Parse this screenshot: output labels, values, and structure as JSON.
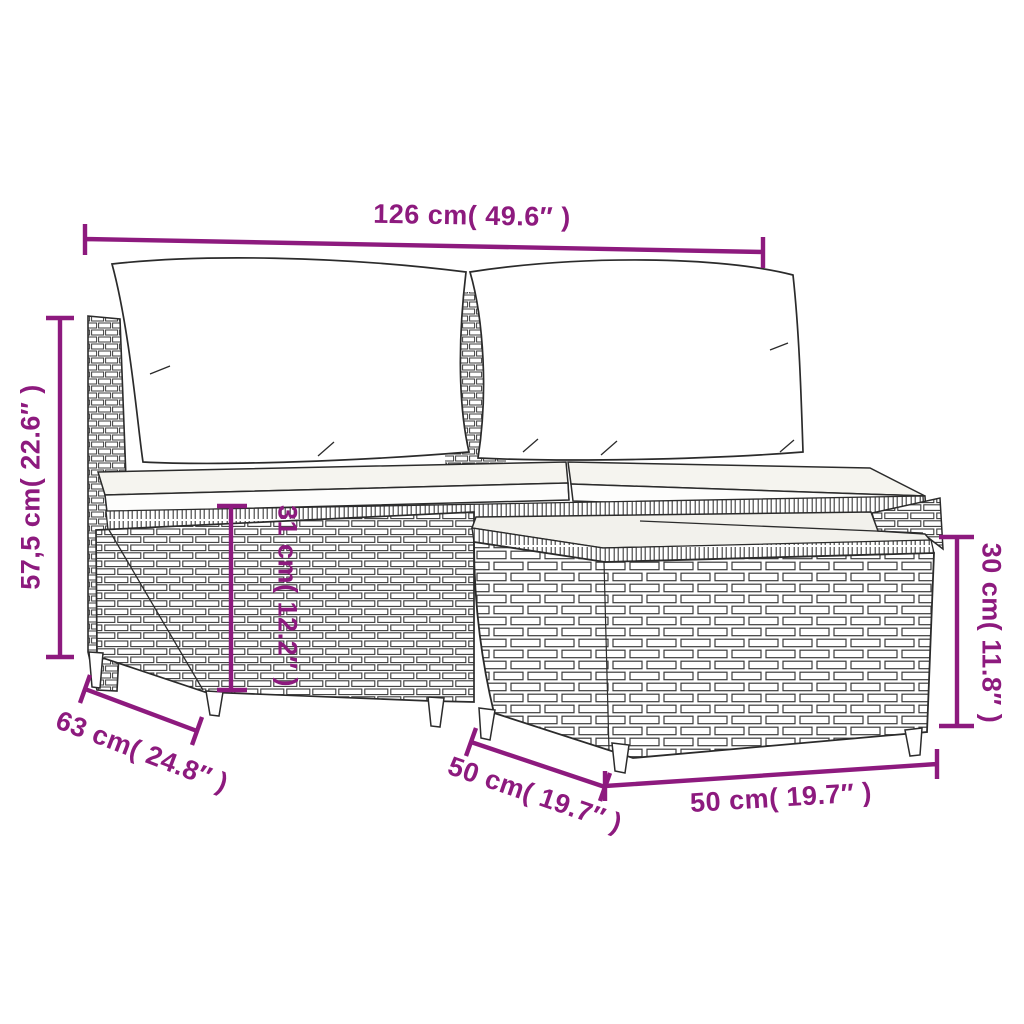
{
  "diagram": {
    "subject": "poly rattan garden lounge set with white cushions and wicker footstool table",
    "style": "black line-art product dimension drawing on white background",
    "annotation_color": "#8d1a7e",
    "line_color": "#2b2b2b",
    "dimensions": [
      {
        "id": "overall-width",
        "label": "126 cm( 49.6″ )",
        "orientation": "horizontal",
        "position": "top"
      },
      {
        "id": "overall-height",
        "label": "57,5 cm( 22.6″ )",
        "orientation": "vertical",
        "position": "left"
      },
      {
        "id": "seat-height",
        "label": "31 cm( 12.2″ )",
        "orientation": "vertical",
        "position": "center"
      },
      {
        "id": "footstool-height",
        "label": "30 cm( 11.8″ )",
        "orientation": "vertical",
        "position": "right"
      },
      {
        "id": "sofa-depth",
        "label": "63 cm( 24.8″ )",
        "orientation": "diagonal",
        "position": "bottom-left"
      },
      {
        "id": "footstool-depth",
        "label": "50 cm( 19.7″ )",
        "orientation": "diagonal",
        "position": "bottom-center"
      },
      {
        "id": "footstool-width",
        "label": "50 cm( 19.7″ )",
        "orientation": "horizontal",
        "position": "bottom-right"
      }
    ]
  }
}
